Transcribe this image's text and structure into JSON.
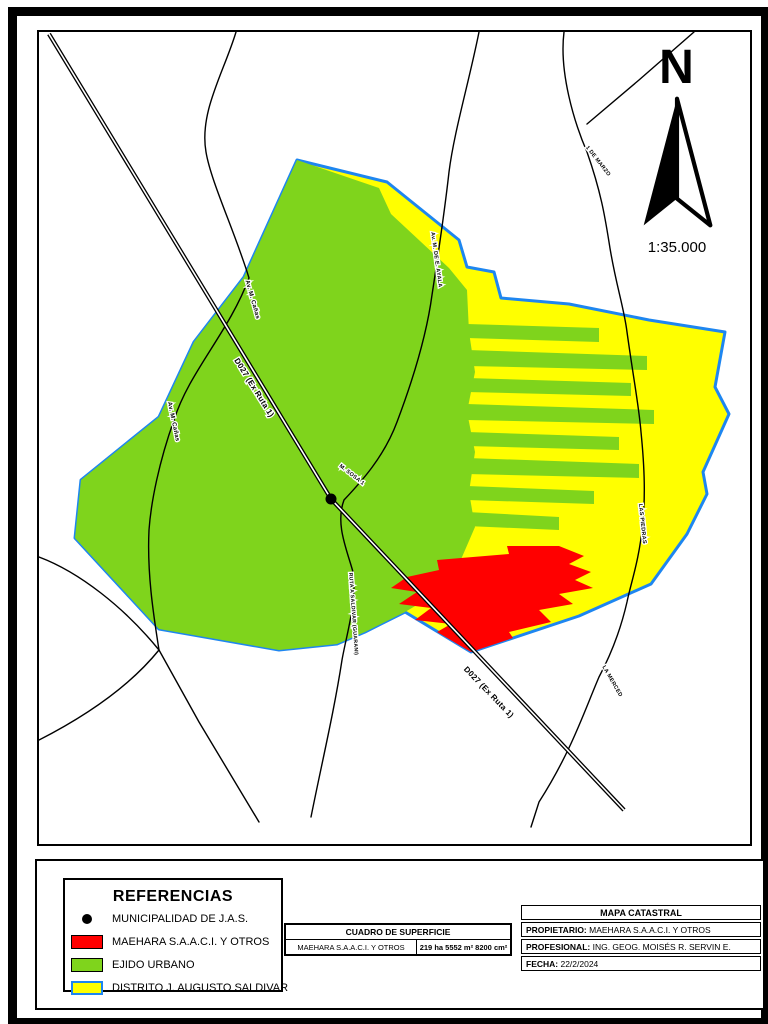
{
  "north": {
    "letter": "N",
    "scale": "1:35.000"
  },
  "legend": {
    "title": "REFERENCIAS",
    "items": [
      {
        "swatch": "municipality-dot",
        "label": "MUNICIPALIDAD DE J.A.S."
      },
      {
        "swatch": "red",
        "label": "MAEHARA S.A.A.C.I. Y OTROS"
      },
      {
        "swatch": "green",
        "label": "EJIDO URBANO"
      },
      {
        "swatch": "yellow",
        "label": "DISTRITO J. AUGUSTO SALDIVAR"
      }
    ]
  },
  "surface_table": {
    "title": "CUADRO DE SUPERFICIE",
    "owner": "MAEHARA S.A.A.C.I. Y OTROS",
    "area": "219 ha 5552 m² 8200 cm²"
  },
  "info_box": {
    "title": "MAPA CATASTRAL",
    "rows": [
      {
        "label": "PROPIETARIO:",
        "value": " MAEHARA S.A.A.C.I. Y OTROS"
      },
      {
        "label": "PROFESIONAL:",
        "value": " ING. GEOG. MOISÉS R. SERVIN E."
      },
      {
        "label": "FECHA:",
        "value": " 22/2/2024"
      }
    ]
  },
  "map": {
    "colors": {
      "ejido_green": "#7fd41c",
      "distrito_yellow": "#ffff00",
      "maehara_red": "#ff0000",
      "boundary_blue": "#1e86f0",
      "road_black": "#000000"
    },
    "road_labels": [
      {
        "text": "D027 (Ex Ruta 1)",
        "x": 213,
        "y": 357,
        "rot": 58,
        "size": 8
      },
      {
        "text": "D027 (Ex Ruta 1)",
        "x": 448,
        "y": 662,
        "rot": 46,
        "size": 8
      },
      {
        "text": "Av. M. Cañas",
        "x": 212,
        "y": 268,
        "rot": 74,
        "size": 6
      },
      {
        "text": "Av. M. Cañas",
        "x": 133,
        "y": 390,
        "rot": 78,
        "size": 6
      },
      {
        "text": "Av. M. DE E. AYALA",
        "x": 396,
        "y": 228,
        "rot": 82,
        "size": 5.5
      },
      {
        "text": "M. SOSA 1",
        "x": 312,
        "y": 444,
        "rot": 38,
        "size": 5.5
      },
      {
        "text": "RUTA A SALDIVAR (GUARANI)",
        "x": 313,
        "y": 582,
        "rot": 86,
        "size": 5.2
      },
      {
        "text": "1 DE MARZO",
        "x": 558,
        "y": 130,
        "rot": 52,
        "size": 5.5
      },
      {
        "text": "LAS PIEDRAS",
        "x": 602,
        "y": 492,
        "rot": 84,
        "size": 5.5
      },
      {
        "text": "LA MERCED",
        "x": 572,
        "y": 650,
        "rot": 60,
        "size": 5.5
      }
    ]
  }
}
